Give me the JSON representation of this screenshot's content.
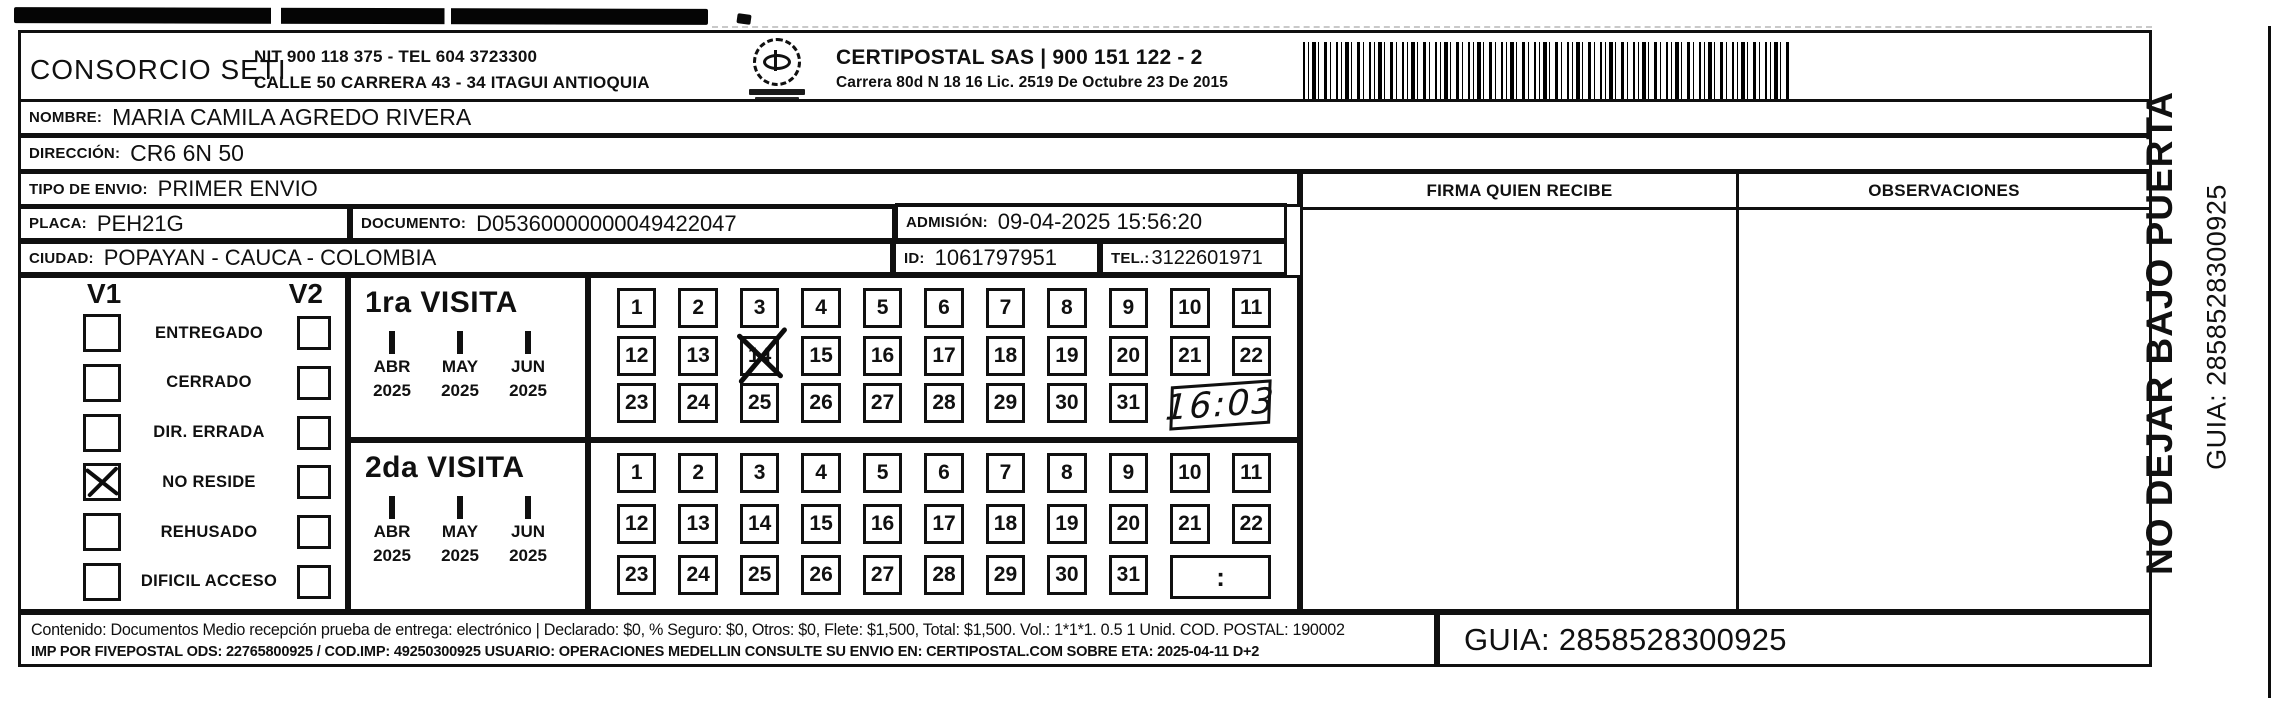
{
  "header": {
    "company": "CONSORCIO SETI",
    "nit_line": "NIT 900 118 375 - TEL 604 3723300",
    "address_line": "CALLE 50 CARRERA 43 - 34 ITAGUI ANTIOQUIA",
    "carrier_line": "CERTIPOSTAL SAS | 900 151 122 - 2",
    "carrier_sub_line": "Carrera 80d N 18 16  Lic. 2519 De Octubre 23 De 2015"
  },
  "fields": {
    "nombre_label": "NOMBRE:",
    "nombre": "MARIA CAMILA AGREDO RIVERA",
    "direccion_label": "DIRECCIÓN:",
    "direccion": "CR6 6N 50",
    "tipo_envio_label": "TIPO DE ENVIO:",
    "tipo_envio": "PRIMER ENVIO",
    "placa_label": "PLACA:",
    "placa": "PEH21G",
    "documento_label": "DOCUMENTO:",
    "documento": "D05360000000049422047",
    "admision_label": "ADMISIÓN:",
    "admision": "09-04-2025 15:56:20",
    "ciudad_label": "CIUDAD:",
    "ciudad": "POPAYAN - CAUCA - COLOMBIA",
    "id_label": "ID:",
    "id": "1061797951",
    "tel_label": "TEL.:",
    "tel": "3122601971"
  },
  "signature": {
    "firma_header": "FIRMA QUIEN RECIBE",
    "observaciones_header": "OBSERVACIONES"
  },
  "status": {
    "v1_label": "V1",
    "v2_label": "V2",
    "items": [
      {
        "label": "ENTREGADO",
        "v1_checked": false,
        "v2_checked": false
      },
      {
        "label": "CERRADO",
        "v1_checked": false,
        "v2_checked": false
      },
      {
        "label": "DIR. ERRADA",
        "v1_checked": false,
        "v2_checked": false
      },
      {
        "label": "NO RESIDE",
        "v1_checked": true,
        "v2_checked": false
      },
      {
        "label": "REHUSADO",
        "v1_checked": false,
        "v2_checked": false
      },
      {
        "label": "DIFICIL ACCESO",
        "v1_checked": false,
        "v2_checked": false
      }
    ]
  },
  "visits": [
    {
      "title": "1ra VISITA",
      "months": [
        {
          "label": "ABR",
          "year": "2025",
          "checked": true
        },
        {
          "label": "MAY",
          "year": "2025",
          "checked": false
        },
        {
          "label": "JUN",
          "year": "2025",
          "checked": false
        }
      ],
      "days": [
        "1",
        "2",
        "3",
        "4",
        "5",
        "6",
        "7",
        "8",
        "9",
        "10",
        "11",
        "12",
        "13",
        "14",
        "15",
        "16",
        "17",
        "18",
        "19",
        "20",
        "21",
        "22",
        "23",
        "24",
        "25",
        "26",
        "27",
        "28",
        "29",
        "30",
        "31"
      ],
      "crossed_day": "14",
      "time_value": "16:03",
      "time_handwritten": true
    },
    {
      "title": "2da VISITA",
      "months": [
        {
          "label": "ABR",
          "year": "2025",
          "checked": false
        },
        {
          "label": "MAY",
          "year": "2025",
          "checked": false
        },
        {
          "label": "JUN",
          "year": "2025",
          "checked": false
        }
      ],
      "days": [
        "1",
        "2",
        "3",
        "4",
        "5",
        "6",
        "7",
        "8",
        "9",
        "10",
        "11",
        "12",
        "13",
        "14",
        "15",
        "16",
        "17",
        "18",
        "19",
        "20",
        "21",
        "22",
        "23",
        "24",
        "25",
        "26",
        "27",
        "28",
        "29",
        "30",
        "31"
      ],
      "crossed_day": null,
      "time_value": ":",
      "time_handwritten": false
    }
  ],
  "footer": {
    "line1": "Contenido: Documentos Medio recepción prueba de entrega: electrónico | Declarado: $0, % Seguro: $0, Otros: $0, Flete: $1,500, Total: $1,500. Vol.: 1*1*1. 0.5  1 Unid. COD. POSTAL: 190002",
    "line2": "IMP POR FIVEPOSTAL ODS: 22765800925 / COD.IMP: 49250300925 USUARIO: OPERACIONES MEDELLIN CONSULTE SU ENVIO EN: CERTIPOSTAL.COM SOBRE ETA: 2025-04-11 D+2",
    "guia": "GUIA: 2858528300925"
  },
  "side": {
    "warning": "NO DEJAR BAJO PUERTA",
    "guia": "GUIA: 2858528300925"
  },
  "colors": {
    "ink": "#101010",
    "paper": "#ffffff"
  }
}
